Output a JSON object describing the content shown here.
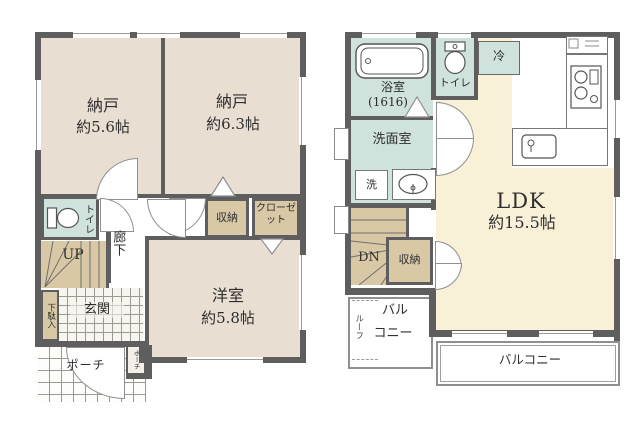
{
  "colors": {
    "wall": "#5e5e5e",
    "room_beige": "#e8dfd2",
    "ldk_cream": "#f8f1d8",
    "wet_teal": "#cfe2dc",
    "stairs_tan": "#d9c8a6"
  },
  "floor1": {
    "storage1_name": "納戸",
    "storage1_area": "約5.6帖",
    "storage2_name": "納戸",
    "storage2_area": "約6.3帖",
    "closet_small": "収納",
    "closet": "クローゼット",
    "western_name": "洋室",
    "western_area": "約5.8帖",
    "toilet": "トイレ",
    "hallway": "廊下",
    "stairs": "UP",
    "shoe_cabinet": "下駄入",
    "entrance": "玄関",
    "porch": "ポーチ",
    "porch_small": "ポーチ"
  },
  "floor2": {
    "bath_name": "浴室",
    "bath_size": "(1616)",
    "toilet": "トイレ",
    "refrigerator": "冷",
    "washroom": "洗面室",
    "washer": "洗",
    "ldk_name": "LDK",
    "ldk_area": "約15.5帖",
    "stairs": "DN",
    "closet": "収納",
    "balcony_small_side": "ルーフ",
    "balcony_small_1": "バル",
    "balcony_small_2": "コニー",
    "balcony": "バルコニー"
  }
}
